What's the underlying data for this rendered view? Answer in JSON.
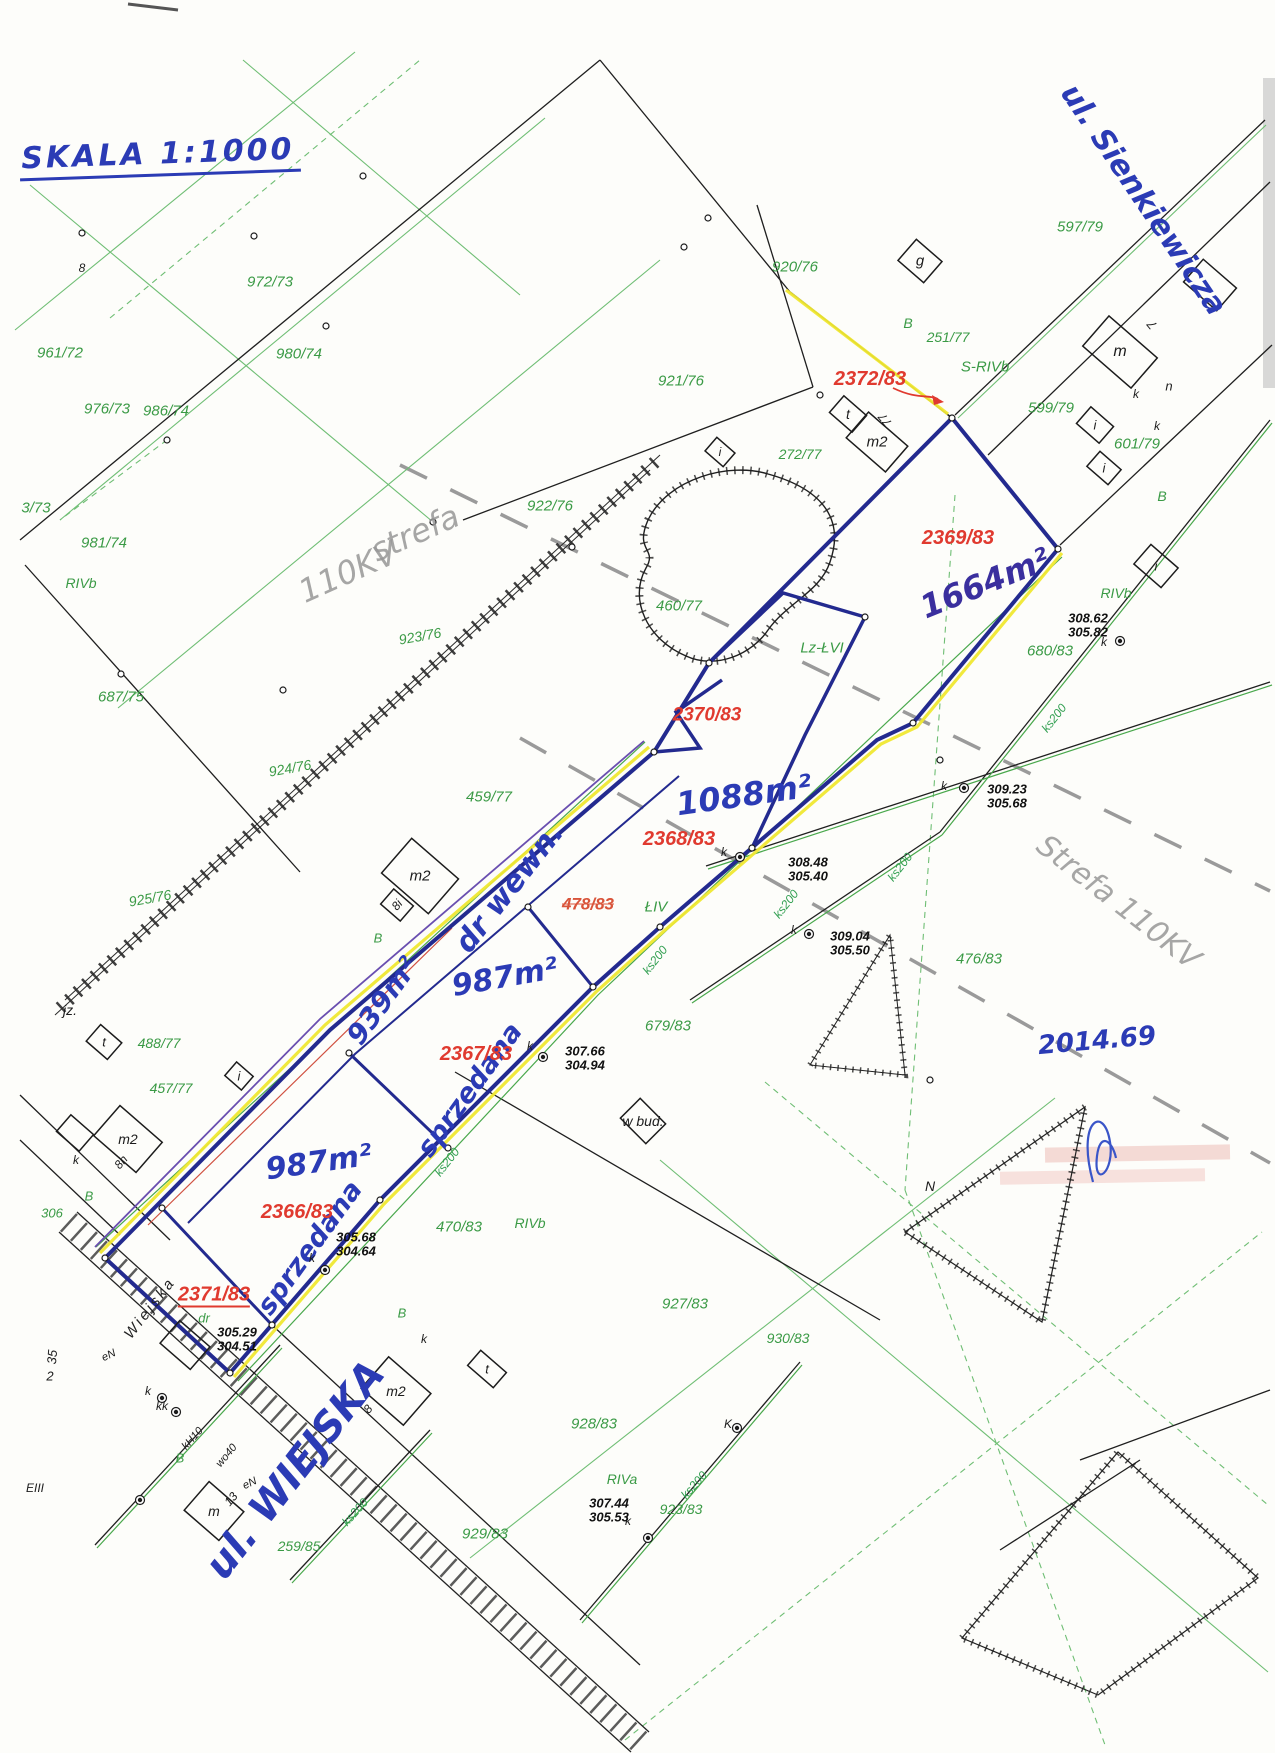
{
  "map": {
    "scale_note": "SKALA 1:1000",
    "streets": [
      "ul. Sienkiewicza",
      "ul. WIEJSKA"
    ],
    "zone_note": "strefa 110KV",
    "colors": {
      "boundary_navy": "#232a8f",
      "road_edge_yellow": "#f2e83c",
      "parcel_green": "#3a9a45",
      "new_parcel_red": "#e03a2f",
      "ink_blue": "#2b3bb5",
      "pencil_gray": "#979797"
    }
  },
  "labels": [
    {
      "t": "SKALA 1:1000",
      "x": 160,
      "y": 158,
      "s": 30,
      "r": -2,
      "k": "sc"
    },
    {
      "t": "ul. Sienkiewicza",
      "x": 1143,
      "y": 200,
      "s": 30,
      "r": 56,
      "k": "hb"
    },
    {
      "t": "2014.69",
      "x": 1097,
      "y": 1041,
      "s": 26,
      "r": -5,
      "k": "hb"
    },
    {
      "t": "1664m²",
      "x": 985,
      "y": 583,
      "s": 32,
      "r": -22,
      "k": "hd"
    },
    {
      "t": "1088m²",
      "x": 744,
      "y": 795,
      "s": 32,
      "r": -8,
      "k": "hb"
    },
    {
      "t": "dr wewn.",
      "x": 510,
      "y": 888,
      "s": 30,
      "r": -52,
      "k": "hb"
    },
    {
      "t": "939m²",
      "x": 383,
      "y": 1001,
      "s": 28,
      "r": -54,
      "k": "hb"
    },
    {
      "t": "987m²",
      "x": 505,
      "y": 978,
      "s": 30,
      "r": -10,
      "k": "hb"
    },
    {
      "t": "987m²",
      "x": 319,
      "y": 1163,
      "s": 30,
      "r": -8,
      "k": "hb"
    },
    {
      "t": "sprzedana",
      "x": 470,
      "y": 1090,
      "s": 27,
      "r": -54,
      "k": "hb"
    },
    {
      "t": "sprzedana",
      "x": 310,
      "y": 1248,
      "s": 27,
      "r": -54,
      "k": "hb"
    },
    {
      "t": "ul. WIEJSKA",
      "x": 295,
      "y": 1470,
      "s": 40,
      "r": -52,
      "k": "hb"
    },
    {
      "t": "strefa",
      "x": 415,
      "y": 533,
      "s": 32,
      "r": -24,
      "k": "pc"
    },
    {
      "t": "110KV",
      "x": 348,
      "y": 572,
      "s": 32,
      "r": -24,
      "k": "pc"
    },
    {
      "t": "Strefa 110KV",
      "x": 1118,
      "y": 903,
      "s": 30,
      "r": 38,
      "k": "pc"
    },
    {
      "t": "2372/83",
      "x": 870,
      "y": 379,
      "s": 20,
      "r": 0,
      "k": "rd"
    },
    {
      "t": "2369/83",
      "x": 958,
      "y": 538,
      "s": 20,
      "r": 0,
      "k": "rd"
    },
    {
      "t": "2370/83",
      "x": 707,
      "y": 715,
      "s": 19,
      "r": 0,
      "k": "rd"
    },
    {
      "t": "2368/83",
      "x": 679,
      "y": 839,
      "s": 20,
      "r": 0,
      "k": "rd"
    },
    {
      "t": "478/83",
      "x": 588,
      "y": 904,
      "s": 17,
      "r": 0,
      "k": "rs"
    },
    {
      "t": "2367/83",
      "x": 476,
      "y": 1054,
      "s": 20,
      "r": 0,
      "k": "rd"
    },
    {
      "t": "2366/83",
      "x": 297,
      "y": 1212,
      "s": 20,
      "r": 0,
      "k": "rd"
    },
    {
      "t": "2371/83",
      "x": 214,
      "y": 1296,
      "s": 20,
      "r": 0,
      "k": "ru"
    },
    {
      "t": "972/73",
      "x": 270,
      "y": 282,
      "s": 15,
      "r": 0,
      "k": "gr"
    },
    {
      "t": "980/74",
      "x": 299,
      "y": 354,
      "s": 15,
      "r": 0,
      "k": "gr"
    },
    {
      "t": "961/72",
      "x": 60,
      "y": 353,
      "s": 15,
      "r": 0,
      "k": "gr"
    },
    {
      "t": "976/73",
      "x": 107,
      "y": 409,
      "s": 15,
      "r": 0,
      "k": "gr"
    },
    {
      "t": "986/74",
      "x": 166,
      "y": 411,
      "s": 15,
      "r": 0,
      "k": "gr"
    },
    {
      "t": "3/73",
      "x": 36,
      "y": 508,
      "s": 15,
      "r": 0,
      "k": "gr"
    },
    {
      "t": "981/74",
      "x": 104,
      "y": 543,
      "s": 15,
      "r": 0,
      "k": "gr"
    },
    {
      "t": "RIVb",
      "x": 81,
      "y": 583,
      "s": 14,
      "r": 0,
      "k": "gr"
    },
    {
      "t": "687/75",
      "x": 121,
      "y": 697,
      "s": 15,
      "r": 0,
      "k": "gr"
    },
    {
      "t": "920/76",
      "x": 795,
      "y": 267,
      "s": 15,
      "r": 0,
      "k": "gr"
    },
    {
      "t": "921/76",
      "x": 681,
      "y": 381,
      "s": 15,
      "r": 0,
      "k": "gr"
    },
    {
      "t": "922/76",
      "x": 550,
      "y": 506,
      "s": 15,
      "r": 0,
      "k": "gr"
    },
    {
      "t": "272/77",
      "x": 800,
      "y": 454,
      "s": 14,
      "r": 0,
      "k": "gr"
    },
    {
      "t": "251/77",
      "x": 948,
      "y": 337,
      "s": 14,
      "r": 0,
      "k": "gr"
    },
    {
      "t": "S-RIVb",
      "x": 985,
      "y": 367,
      "s": 15,
      "r": 0,
      "k": "gr"
    },
    {
      "t": "597/79",
      "x": 1080,
      "y": 227,
      "s": 15,
      "r": 0,
      "k": "gr"
    },
    {
      "t": "599/79",
      "x": 1051,
      "y": 408,
      "s": 15,
      "r": 0,
      "k": "gr"
    },
    {
      "t": "601/79",
      "x": 1137,
      "y": 444,
      "s": 15,
      "r": 0,
      "k": "gr"
    },
    {
      "t": "B",
      "x": 908,
      "y": 323,
      "s": 14,
      "r": 0,
      "k": "gr"
    },
    {
      "t": "B",
      "x": 1162,
      "y": 496,
      "s": 14,
      "r": 0,
      "k": "gr"
    },
    {
      "t": "680/83",
      "x": 1050,
      "y": 651,
      "s": 15,
      "r": 0,
      "k": "gr"
    },
    {
      "t": "RIVb",
      "x": 1116,
      "y": 593,
      "s": 14,
      "r": 0,
      "k": "gr"
    },
    {
      "t": "Lz-ŁVI",
      "x": 822,
      "y": 648,
      "s": 15,
      "r": 0,
      "k": "gr"
    },
    {
      "t": "460/77",
      "x": 679,
      "y": 606,
      "s": 15,
      "r": 0,
      "k": "gr"
    },
    {
      "t": "923/76",
      "x": 420,
      "y": 636,
      "s": 14,
      "r": -10,
      "k": "gr"
    },
    {
      "t": "924/76",
      "x": 290,
      "y": 768,
      "s": 14,
      "r": -10,
      "k": "gr"
    },
    {
      "t": "925/76",
      "x": 150,
      "y": 898,
      "s": 14,
      "r": -10,
      "k": "gr"
    },
    {
      "t": "459/77",
      "x": 489,
      "y": 797,
      "s": 15,
      "r": 0,
      "k": "gr"
    },
    {
      "t": "ŁIV",
      "x": 656,
      "y": 907,
      "s": 15,
      "r": 0,
      "k": "gr"
    },
    {
      "t": "679/83",
      "x": 668,
      "y": 1026,
      "s": 15,
      "r": 0,
      "k": "gr"
    },
    {
      "t": "470/83",
      "x": 459,
      "y": 1227,
      "s": 15,
      "r": 0,
      "k": "gr"
    },
    {
      "t": "RIVb",
      "x": 530,
      "y": 1223,
      "s": 14,
      "r": 0,
      "k": "gr"
    },
    {
      "t": "476/83",
      "x": 979,
      "y": 959,
      "s": 15,
      "r": 0,
      "k": "gr"
    },
    {
      "t": "488/77",
      "x": 159,
      "y": 1043,
      "s": 14,
      "r": 0,
      "k": "gr"
    },
    {
      "t": "457/77",
      "x": 171,
      "y": 1088,
      "s": 14,
      "r": 0,
      "k": "gr"
    },
    {
      "t": "B",
      "x": 378,
      "y": 938,
      "s": 13,
      "r": 0,
      "k": "gr"
    },
    {
      "t": "B",
      "x": 89,
      "y": 1196,
      "s": 13,
      "r": 0,
      "k": "gr"
    },
    {
      "t": "306",
      "x": 52,
      "y": 1213,
      "s": 13,
      "r": 0,
      "k": "gr"
    },
    {
      "t": "dr",
      "x": 204,
      "y": 1318,
      "s": 13,
      "r": 0,
      "k": "gr"
    },
    {
      "t": "B",
      "x": 180,
      "y": 1458,
      "s": 13,
      "r": 0,
      "k": "gr"
    },
    {
      "t": "259/85",
      "x": 299,
      "y": 1546,
      "s": 14,
      "r": 0,
      "k": "gr"
    },
    {
      "t": "927/83",
      "x": 685,
      "y": 1304,
      "s": 15,
      "r": 0,
      "k": "gr"
    },
    {
      "t": "928/83",
      "x": 594,
      "y": 1424,
      "s": 15,
      "r": 0,
      "k": "gr"
    },
    {
      "t": "RIVa",
      "x": 622,
      "y": 1479,
      "s": 14,
      "r": 0,
      "k": "gr"
    },
    {
      "t": "929/83",
      "x": 485,
      "y": 1534,
      "s": 15,
      "r": 0,
      "k": "gr"
    },
    {
      "t": "923/83",
      "x": 681,
      "y": 1509,
      "s": 14,
      "r": 0,
      "k": "gr"
    },
    {
      "t": "930/83",
      "x": 788,
      "y": 1338,
      "s": 14,
      "r": 0,
      "k": "gr"
    },
    {
      "t": "B",
      "x": 402,
      "y": 1313,
      "s": 13,
      "r": 0,
      "k": "gr"
    },
    {
      "t": "ks200",
      "x": 1054,
      "y": 718,
      "s": 12,
      "r": -52,
      "k": "ks"
    },
    {
      "t": "ks200",
      "x": 900,
      "y": 867,
      "s": 12,
      "r": -52,
      "k": "ks"
    },
    {
      "t": "ks200",
      "x": 786,
      "y": 904,
      "s": 12,
      "r": -52,
      "k": "ks"
    },
    {
      "t": "ks200",
      "x": 655,
      "y": 960,
      "s": 12,
      "r": -52,
      "k": "ks"
    },
    {
      "t": "ks200",
      "x": 447,
      "y": 1162,
      "s": 12,
      "r": -52,
      "k": "ks"
    },
    {
      "t": "ks200",
      "x": 694,
      "y": 1485,
      "s": 12,
      "r": -48,
      "k": "ks"
    },
    {
      "t": "ks200",
      "x": 355,
      "y": 1512,
      "s": 12,
      "r": -48,
      "k": "ks"
    },
    {
      "t": "m",
      "x": 1120,
      "y": 352,
      "s": 16,
      "r": 0,
      "k": "bk"
    },
    {
      "t": "7",
      "x": 1152,
      "y": 325,
      "s": 13,
      "r": -130,
      "k": "bk"
    },
    {
      "t": "g",
      "x": 920,
      "y": 261,
      "s": 15,
      "r": 0,
      "k": "bk"
    },
    {
      "t": "t",
      "x": 848,
      "y": 414,
      "s": 14,
      "r": 0,
      "k": "bk"
    },
    {
      "t": "m2",
      "x": 877,
      "y": 442,
      "s": 15,
      "r": 0,
      "k": "bk"
    },
    {
      "t": "77",
      "x": 885,
      "y": 420,
      "s": 12,
      "r": -130,
      "k": "bk"
    },
    {
      "t": "n",
      "x": 1169,
      "y": 386,
      "s": 13,
      "r": 0,
      "k": "bk"
    },
    {
      "t": "k",
      "x": 1136,
      "y": 394,
      "s": 12,
      "r": 0,
      "k": "bk"
    },
    {
      "t": "k",
      "x": 1157,
      "y": 426,
      "s": 12,
      "r": 0,
      "k": "bk"
    },
    {
      "t": "k",
      "x": 1104,
      "y": 642,
      "s": 12,
      "r": 0,
      "k": "bk"
    },
    {
      "t": "k",
      "x": 944,
      "y": 786,
      "s": 12,
      "r": 0,
      "k": "bk"
    },
    {
      "t": "k",
      "x": 724,
      "y": 852,
      "s": 12,
      "r": 0,
      "k": "bk"
    },
    {
      "t": "k",
      "x": 794,
      "y": 930,
      "s": 12,
      "r": 0,
      "k": "bk"
    },
    {
      "t": "k",
      "x": 530,
      "y": 1046,
      "s": 12,
      "r": 0,
      "k": "bk"
    },
    {
      "t": "k",
      "x": 312,
      "y": 1258,
      "s": 12,
      "r": 0,
      "k": "bk"
    },
    {
      "t": "k",
      "x": 424,
      "y": 1339,
      "s": 12,
      "r": 0,
      "k": "bk"
    },
    {
      "t": "k",
      "x": 628,
      "y": 1521,
      "s": 12,
      "r": 0,
      "k": "bk"
    },
    {
      "t": "K",
      "x": 728,
      "y": 1424,
      "s": 12,
      "r": 0,
      "k": "bk"
    },
    {
      "t": "k",
      "x": 148,
      "y": 1391,
      "s": 12,
      "r": 0,
      "k": "bk"
    },
    {
      "t": "kk",
      "x": 162,
      "y": 1406,
      "s": 12,
      "r": 0,
      "k": "bk"
    },
    {
      "t": "k",
      "x": 76,
      "y": 1160,
      "s": 12,
      "r": 0,
      "k": "bk"
    },
    {
      "t": "i",
      "x": 1095,
      "y": 425,
      "s": 13,
      "r": 0,
      "k": "bk"
    },
    {
      "t": "i",
      "x": 1104,
      "y": 468,
      "s": 13,
      "r": 0,
      "k": "bk"
    },
    {
      "t": "i",
      "x": 1156,
      "y": 566,
      "s": 13,
      "r": 0,
      "k": "bk"
    },
    {
      "t": "i",
      "x": 239,
      "y": 1076,
      "s": 13,
      "r": 0,
      "k": "bk"
    },
    {
      "t": "i",
      "x": 720,
      "y": 452,
      "s": 12,
      "r": 0,
      "k": "bk"
    },
    {
      "t": "m2",
      "x": 420,
      "y": 876,
      "s": 15,
      "r": 0,
      "k": "bk"
    },
    {
      "t": "8i",
      "x": 397,
      "y": 905,
      "s": 12,
      "r": -50,
      "k": "bk"
    },
    {
      "t": "m2",
      "x": 128,
      "y": 1139,
      "s": 14,
      "r": 0,
      "k": "bk"
    },
    {
      "t": "8h",
      "x": 121,
      "y": 1162,
      "s": 12,
      "r": -50,
      "k": "bk"
    },
    {
      "t": "m2",
      "x": 396,
      "y": 1391,
      "s": 14,
      "r": 0,
      "k": "bk"
    },
    {
      "t": "8",
      "x": 368,
      "y": 1409,
      "s": 12,
      "r": -50,
      "k": "bk"
    },
    {
      "t": "m",
      "x": 214,
      "y": 1511,
      "s": 14,
      "r": 0,
      "k": "bk"
    },
    {
      "t": "13",
      "x": 231,
      "y": 1499,
      "s": 12,
      "r": -50,
      "k": "bk"
    },
    {
      "t": "t",
      "x": 104,
      "y": 1042,
      "s": 13,
      "r": 0,
      "k": "bk"
    },
    {
      "t": "t",
      "x": 487,
      "y": 1369,
      "s": 13,
      "r": 0,
      "k": "bk"
    },
    {
      "t": "jz.",
      "x": 70,
      "y": 1010,
      "s": 14,
      "r": 0,
      "k": "bk"
    },
    {
      "t": "w bud.",
      "x": 643,
      "y": 1121,
      "s": 14,
      "r": 0,
      "k": "bk"
    },
    {
      "t": "EIII",
      "x": 35,
      "y": 1488,
      "s": 12,
      "r": 0,
      "k": "bk"
    },
    {
      "t": "35",
      "x": 52,
      "y": 1357,
      "s": 13,
      "r": -85,
      "k": "bk"
    },
    {
      "t": "2",
      "x": 50,
      "y": 1376,
      "s": 13,
      "r": 0,
      "k": "bk"
    },
    {
      "t": "eN",
      "x": 109,
      "y": 1356,
      "s": 11,
      "r": -25,
      "k": "bk"
    },
    {
      "t": "eN",
      "x": 250,
      "y": 1484,
      "s": 11,
      "r": -25,
      "k": "bk"
    },
    {
      "t": "wo40",
      "x": 227,
      "y": 1456,
      "s": 11,
      "r": -50,
      "k": "bk"
    },
    {
      "t": "kH10",
      "x": 193,
      "y": 1439,
      "s": 11,
      "r": -48,
      "k": "bk"
    },
    {
      "t": "N",
      "x": 930,
      "y": 1186,
      "s": 14,
      "r": 0,
      "k": "bk"
    },
    {
      "t": "8",
      "x": 82,
      "y": 268,
      "s": 12,
      "r": 0,
      "k": "bk"
    },
    {
      "t": "Wiejska",
      "x": 150,
      "y": 1308,
      "s": 15,
      "r": -52,
      "k": "st"
    },
    {
      "t": "308.62",
      "x": 1088,
      "y": 618,
      "s": 13,
      "r": 0,
      "k": "el"
    },
    {
      "t": "305.82",
      "x": 1088,
      "y": 632,
      "s": 13,
      "r": 0,
      "k": "el"
    },
    {
      "t": "309.23",
      "x": 1007,
      "y": 789,
      "s": 13,
      "r": 0,
      "k": "el"
    },
    {
      "t": "305.68",
      "x": 1007,
      "y": 803,
      "s": 13,
      "r": 0,
      "k": "el"
    },
    {
      "t": "308.48",
      "x": 808,
      "y": 862,
      "s": 13,
      "r": 0,
      "k": "el"
    },
    {
      "t": "305.40",
      "x": 808,
      "y": 876,
      "s": 13,
      "r": 0,
      "k": "el"
    },
    {
      "t": "309.04",
      "x": 850,
      "y": 936,
      "s": 13,
      "r": 0,
      "k": "el"
    },
    {
      "t": "305.50",
      "x": 850,
      "y": 950,
      "s": 13,
      "r": 0,
      "k": "el"
    },
    {
      "t": "307.66",
      "x": 585,
      "y": 1051,
      "s": 13,
      "r": 0,
      "k": "el"
    },
    {
      "t": "304.94",
      "x": 585,
      "y": 1065,
      "s": 13,
      "r": 0,
      "k": "el"
    },
    {
      "t": "305.68",
      "x": 356,
      "y": 1237,
      "s": 13,
      "r": 0,
      "k": "el"
    },
    {
      "t": "304.64",
      "x": 356,
      "y": 1251,
      "s": 13,
      "r": 0,
      "k": "el"
    },
    {
      "t": "305.29",
      "x": 237,
      "y": 1332,
      "s": 13,
      "r": 0,
      "k": "el"
    },
    {
      "t": "304.51",
      "x": 237,
      "y": 1346,
      "s": 13,
      "r": 0,
      "k": "el"
    },
    {
      "t": "307.44",
      "x": 609,
      "y": 1503,
      "s": 13,
      "r": 0,
      "k": "el"
    },
    {
      "t": "305.53",
      "x": 609,
      "y": 1517,
      "s": 13,
      "r": 0,
      "k": "el"
    }
  ]
}
